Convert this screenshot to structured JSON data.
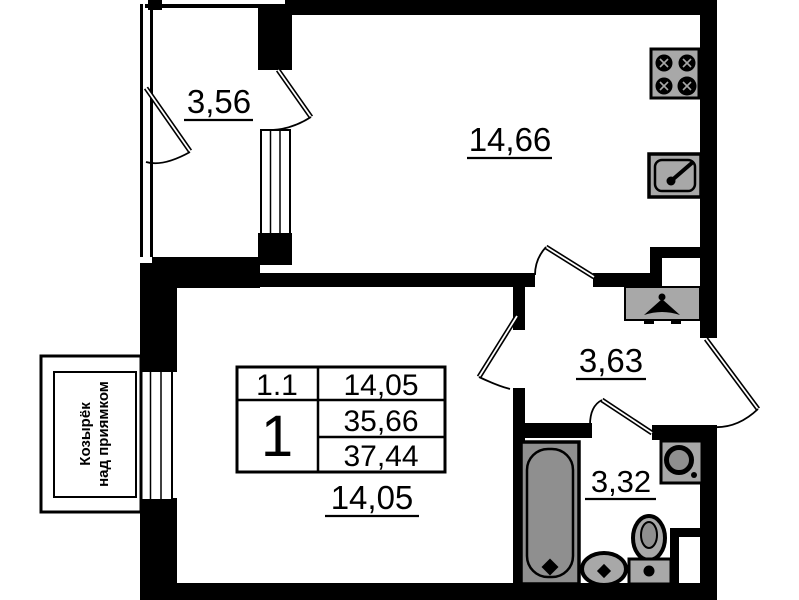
{
  "plan": {
    "type": "apartment-floor-plan",
    "colors": {
      "walls": "#000000",
      "fixtures": "#a8a8a8",
      "background": "#ffffff"
    },
    "rooms": {
      "balcony": {
        "area": "3,56"
      },
      "kitchen": {
        "area": "14,66"
      },
      "hallway": {
        "area": "3,63"
      },
      "bathroom": {
        "area": "3,32"
      },
      "living": {
        "area": "14,05"
      }
    },
    "info_table": {
      "unit": "1.1",
      "living_area": "14,05",
      "rooms_count": "1",
      "area_living_total": "35,66",
      "area_total": "37,44"
    },
    "canopy": {
      "line1": "Козырёк",
      "line2": "над приямком"
    },
    "fixtures": [
      "stove-icon",
      "kitchen-sink-icon",
      "wardrobe-icon",
      "hanger-icon",
      "bathtub-icon",
      "wash-basin-icon",
      "toilet-icon",
      "washing-machine-icon"
    ]
  }
}
